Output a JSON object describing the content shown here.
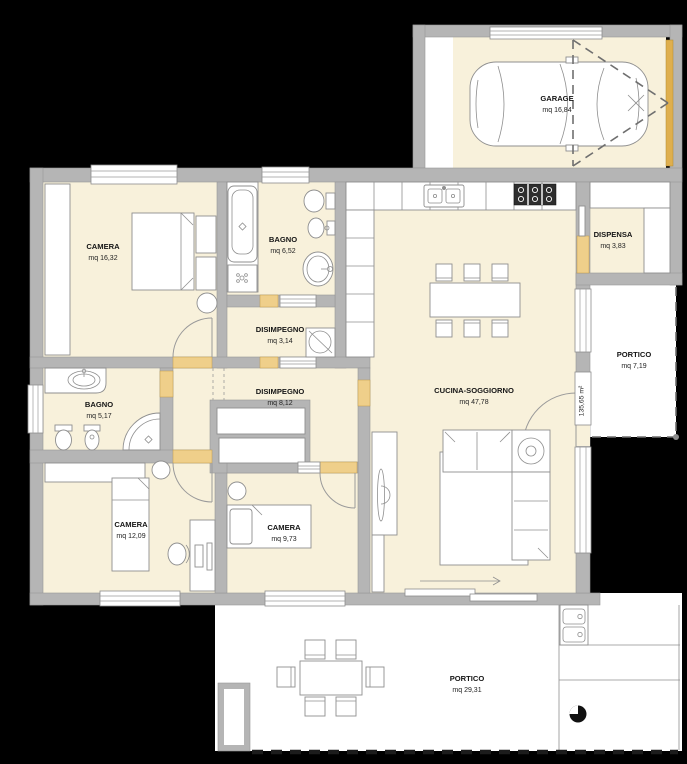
{
  "plan": {
    "type": "residential-floor-plan",
    "total_area_label": "135,65 m²",
    "rooms": [
      {
        "id": "garage",
        "name": "GARAGE",
        "area": "mq 16,84"
      },
      {
        "id": "camera-matrimoniale",
        "name": "CAMERA",
        "area": "mq 16,32"
      },
      {
        "id": "bagno-principale",
        "name": "BAGNO",
        "area": "mq 6,52"
      },
      {
        "id": "disimpegno-1",
        "name": "DISIMPEGNO",
        "area": "mq 3,14"
      },
      {
        "id": "dispensa",
        "name": "DISPENSA",
        "area": "mq 3,83"
      },
      {
        "id": "cucina-soggiorno",
        "name": "CUCINA-SOGGIORNO",
        "area": "mq 47,78"
      },
      {
        "id": "portico-est",
        "name": "PORTICO",
        "area": "mq 7,19"
      },
      {
        "id": "bagno-2",
        "name": "BAGNO",
        "area": "mq 5,17"
      },
      {
        "id": "disimpegno-2",
        "name": "DISIMPEGNO",
        "area": "mq 8,12"
      },
      {
        "id": "camera-2",
        "name": "CAMERA",
        "area": "mq 12,09"
      },
      {
        "id": "camera-3",
        "name": "CAMERA",
        "area": "mq 9,73"
      },
      {
        "id": "portico-sud",
        "name": "PORTICO",
        "area": "mq 29,31"
      }
    ],
    "colors": {
      "background": "#000000",
      "wall": "#b5b5b5",
      "floor": "#f8f1db",
      "door": "#efcf8a",
      "garage_door": "#dfaf4e",
      "fixture_line": "#8f8f8f"
    }
  }
}
